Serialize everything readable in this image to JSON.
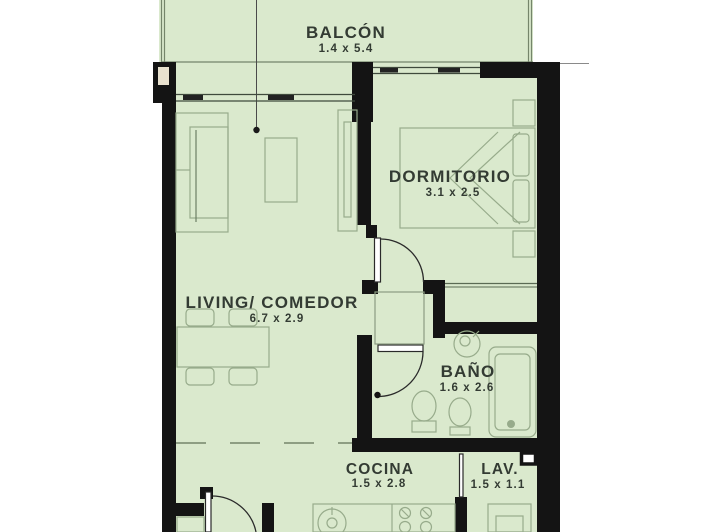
{
  "plan": {
    "type": "apartment-floor-plan",
    "rooms": [
      {
        "id": "balcon",
        "name": "BALCÓN",
        "dims": "1.4 x 5.4"
      },
      {
        "id": "dormitorio",
        "name": "DORMITORIO",
        "dims": "3.1 x 2.5"
      },
      {
        "id": "living",
        "name": "LIVING/ COMEDOR",
        "dims": "6.7 x 2.9"
      },
      {
        "id": "bano",
        "name": "BAÑO",
        "dims": "1.6 x 2.6"
      },
      {
        "id": "cocina",
        "name": "COCINA",
        "dims": "1.5 x 2.8"
      },
      {
        "id": "lav",
        "name": "LAV.",
        "dims": "1.5 x 1.1"
      }
    ],
    "colors": {
      "floor_green": "#dae9cd",
      "wall_black": "#141414",
      "furniture_line": "#97ab8b",
      "label_text": "#333b33",
      "column_inner": "#e9e2cf"
    }
  }
}
